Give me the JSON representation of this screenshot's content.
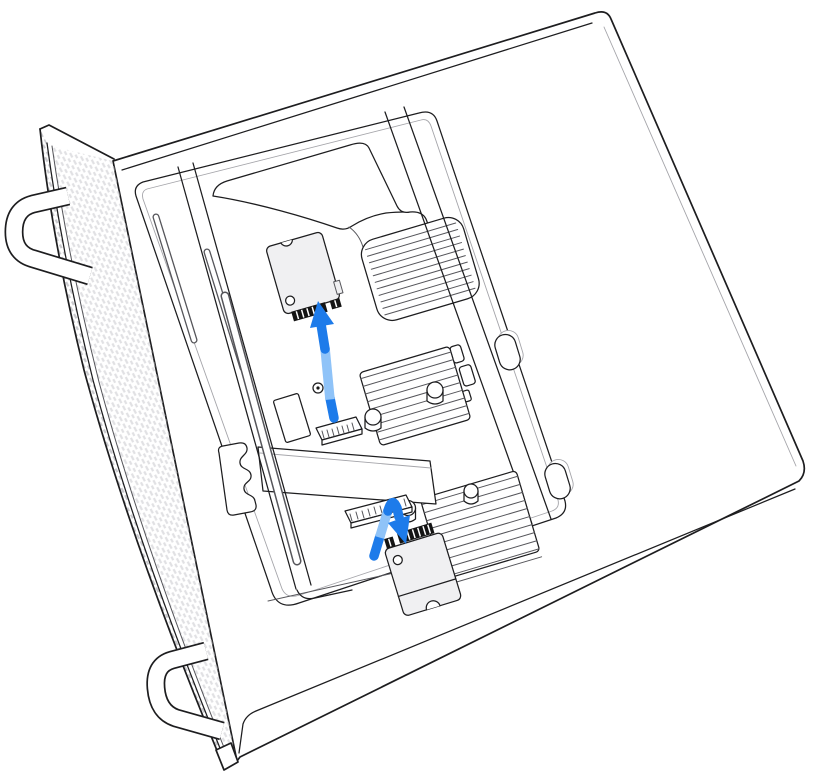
{
  "figure": {
    "alt": "Line art illustration of a Mac Pro lying on its side with its housing removed: one SSD module is lifted away from its connector with a blue arrow pointing up, and a second SSD module is being lowered onto its connector with a bent blue arrow pointing down.",
    "subject": "Mac Pro SSD module removal and installation"
  },
  "colors": {
    "background": "#ffffff",
    "line": "#1d1d1f",
    "line_soft": "#55555a",
    "line_faint": "#a5a5aa",
    "hatch": "#c9c9cd",
    "ssd_fill": "#f0f0f2",
    "teeth": "#141414",
    "arrow_dark": "#1d7bea",
    "arrow_light": "#8fc3f8",
    "white": "#ffffff"
  }
}
